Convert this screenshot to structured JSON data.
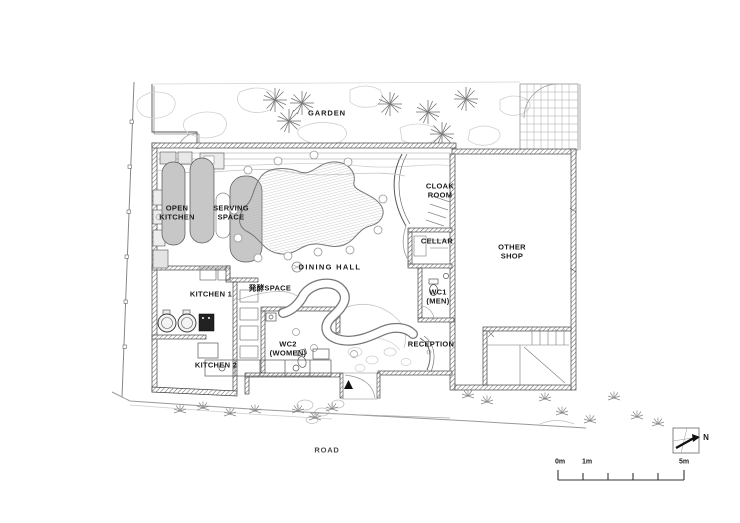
{
  "plan": {
    "rooms": {
      "garden": "GARDEN",
      "open_kitchen": "OPEN\nKITCHEN",
      "serving_space": "SERVING\nSPACE",
      "dining_hall": "DINING HALL",
      "cloak_room": "CLOAK\nROOM",
      "cellar": "CELLAR",
      "other_shop": "OTHER\nSHOP",
      "kitchen_1": "KITCHEN 1",
      "fermentation_space": "発酵SPACE",
      "wc1_men": "WC1\n(MEN)",
      "wc2_women": "WC2\n(WOMEN)",
      "kitchen_2": "KITCHEN 2",
      "reception": "RECEPTION",
      "road": "ROAD"
    },
    "scale_bar": {
      "labels": [
        "0m",
        "1m",
        "5m"
      ]
    },
    "compass": {
      "north_label": "N"
    },
    "colors": {
      "line_dark": "#444444",
      "line_light": "#c4c4c4",
      "furniture_gray": "#c7c7c7",
      "stove_black": "#222222"
    }
  }
}
